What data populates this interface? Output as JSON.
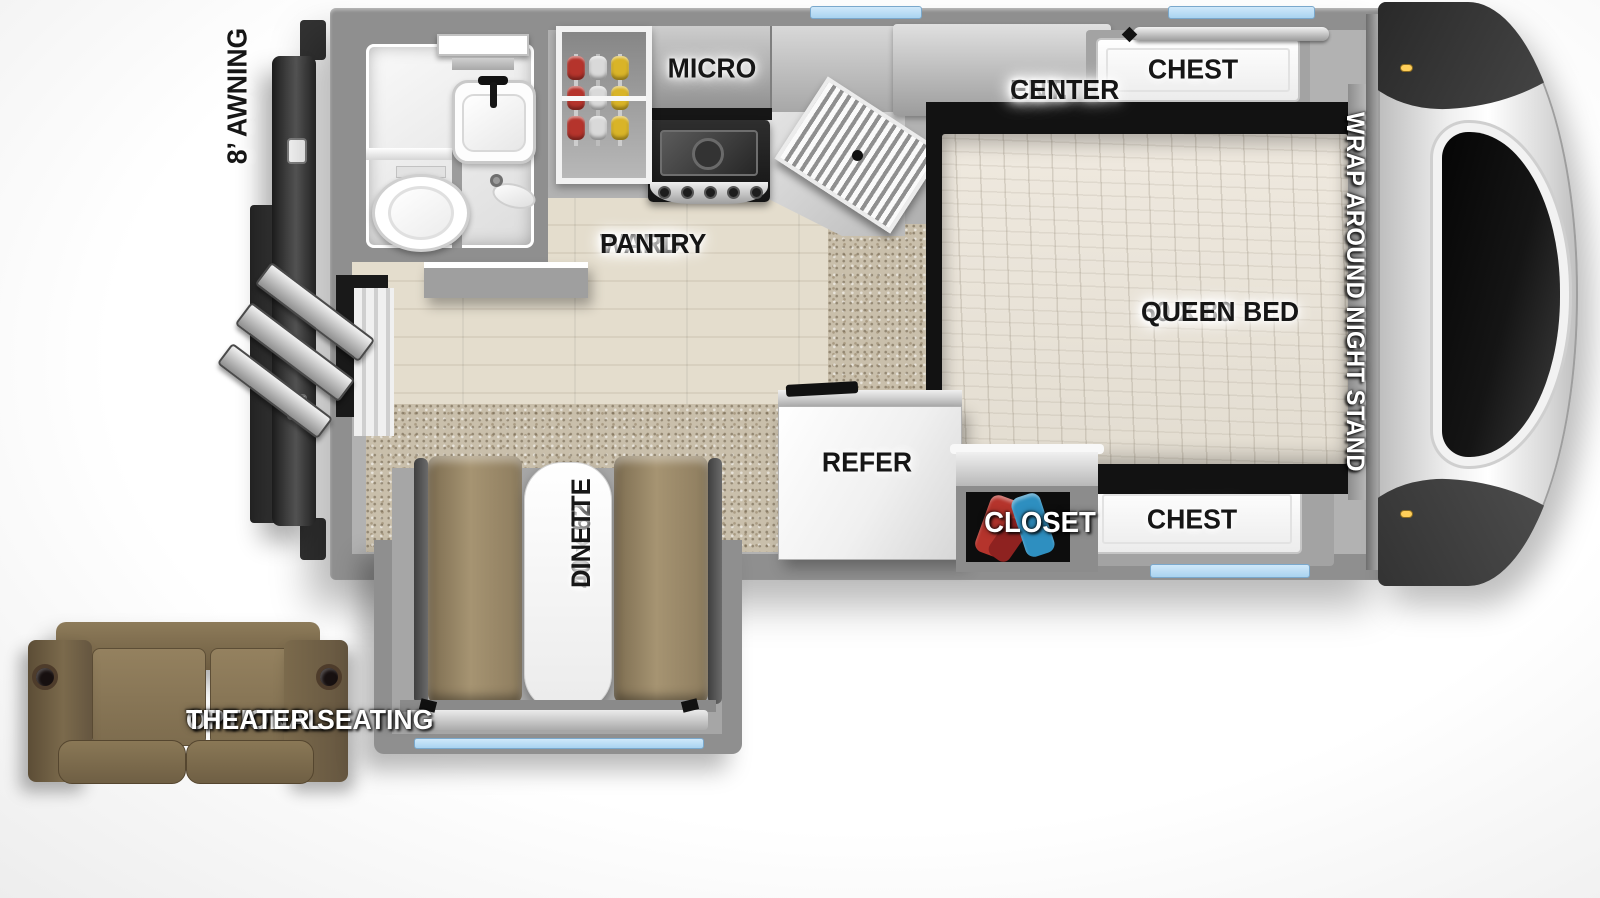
{
  "title": "Truck camper floorplan",
  "labels": {
    "awning": "8’ AWNING",
    "micro": "MICRO",
    "ward_pantry": [
      "WARD",
      "PANTRY"
    ],
    "ent_center": [
      "ENT.",
      "CENTER"
    ],
    "chest_top": "CHEST",
    "queen_bed": [
      "60 X 80",
      "QUEEN BED"
    ],
    "night_stand": "WRAP AROUND NIGHT STAND",
    "refer": "REFER",
    "closet": "CLOSET",
    "chest_bottom": "CHEST",
    "dinette": [
      "40 x 62",
      "DINETTE"
    ],
    "theater_seating": [
      "OPTIONAL",
      "THEATER SEATING"
    ]
  },
  "colors": {
    "wall_gray": "#8f8f8f",
    "interior_gray": "#b2b2b2",
    "floor_wood": "#ded7c8",
    "carpet_tan": "#c9bfab",
    "bench_tan": "#9a8a6c",
    "sofa_brown": "#7d6c4e",
    "window_blue": "#a9d3f0",
    "tv_blue": "#2f5fd0",
    "mattress_cream": "#e9e4da",
    "label_black": "#161616",
    "hanger_red": "#b5342c",
    "hanger_yellow": "#d9b428",
    "hanger_blue": "#2e8fc0",
    "awning_dark": "#2e2e2e"
  }
}
